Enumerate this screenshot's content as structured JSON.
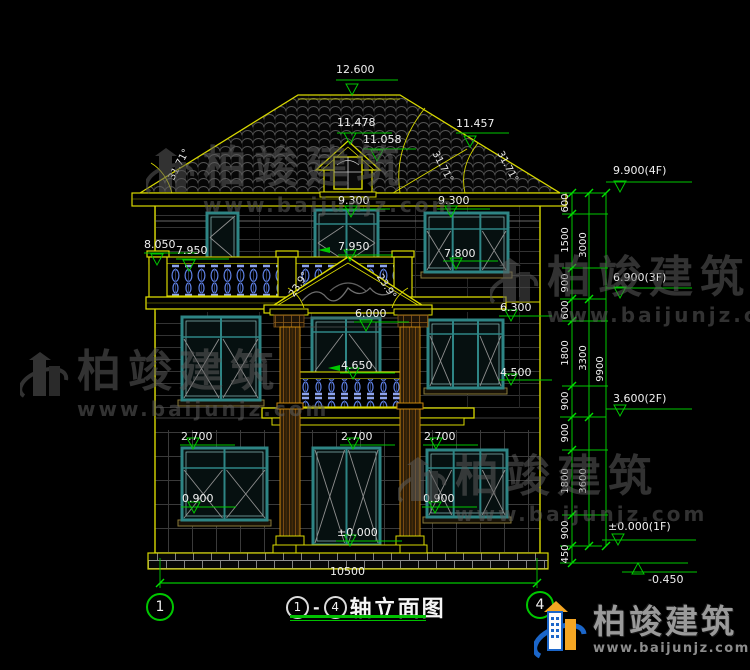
{
  "title_bar": {
    "axis_left_bubble": "1",
    "axis_right_bubble": "4",
    "circle_start": "1",
    "circle_end": "4",
    "separator": "-",
    "name": "轴立面图"
  },
  "top_dims": {
    "ridge": "12.600",
    "dormer_peak": "11.478",
    "dormer_eave": "11.058",
    "hip": "11.457",
    "eave_left": "9.300",
    "eave_right": "9.300"
  },
  "left_dims": {
    "railing_top": "8.050",
    "balcony_slab": "7.950"
  },
  "mid_dims": {
    "pediment_peak": "7.950",
    "win3_sill": "7.800",
    "win2_head": "6.300",
    "porch_beam": "6.000",
    "balcony2_rail": "4.650",
    "win2_sill": "4.500",
    "win1_head_left": "2.700",
    "door1_head": "2.700",
    "win1_head_right": "2.700",
    "win1_sill_left": "0.900",
    "win1_sill_right": "0.900",
    "door1_floor": "±0.000"
  },
  "angles": {
    "roof_left": "31.71°",
    "roof_right_a": "31.71°",
    "roof_right_b": "31.71°",
    "pediment_left": "23.9°",
    "pediment_right": "23.9°"
  },
  "right_levels": {
    "l4": "9.900(4F)",
    "l3": "6.900(3F)",
    "l2": "3.600(2F)",
    "l1": "±0.000(1F)",
    "lbase": "-0.450"
  },
  "chain": {
    "col1": [
      "600",
      "1500",
      "900",
      "600",
      "1800",
      "900",
      "900",
      "1800",
      "900",
      "450"
    ],
    "col2": [
      "3000",
      "3300",
      "3600"
    ],
    "col3": "9900"
  },
  "bottom_dims": {
    "total_width": "10500"
  },
  "watermark": {
    "brand": "柏竣建筑",
    "url": "www.baijunjz.com"
  },
  "logo": {
    "brand": "柏竣建筑",
    "url": "www.baijunjz.com"
  },
  "colors": {
    "line_yellow": "#d8d800",
    "dim_green": "#00c800",
    "window_teal": "#2e8585",
    "baluster_blue": "#5f82e8",
    "text_white": "#f0f0f0"
  }
}
